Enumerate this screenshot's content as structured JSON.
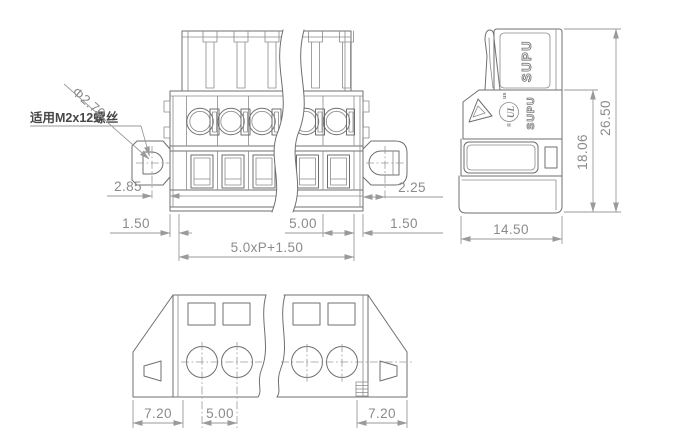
{
  "drawing": {
    "title_hint": "terminal block dimensional drawing",
    "front_view": {
      "note_label": "适用M2x12螺丝",
      "hole_dia_label": "Φ2.70",
      "dims": {
        "left_flange_offset": "2.85",
        "right_flange_offset": "2.25",
        "left_end": "1.50",
        "pitch": "5.00",
        "right_end": "1.50",
        "total_length_formula": "5.0xP+1.50"
      }
    },
    "side_view": {
      "dims": {
        "body_height": "18.06",
        "total_height": "26.50",
        "depth": "14.50"
      },
      "markings": {
        "brand_plug": "SUPU",
        "brand_body": "SUPU",
        "cert": "UL",
        "cert_location": "us",
        "registered": "®"
      }
    },
    "bottom_view": {
      "dims": {
        "left_flange_width": "7.20",
        "pitch": "5.00",
        "right_flange_width": "7.20"
      }
    }
  },
  "colors": {
    "line": "#6f6f6f",
    "dim": "#9a9a9a",
    "dimtext": "#8b8b8b",
    "dark": "#474747",
    "bg": "#ffffff"
  }
}
